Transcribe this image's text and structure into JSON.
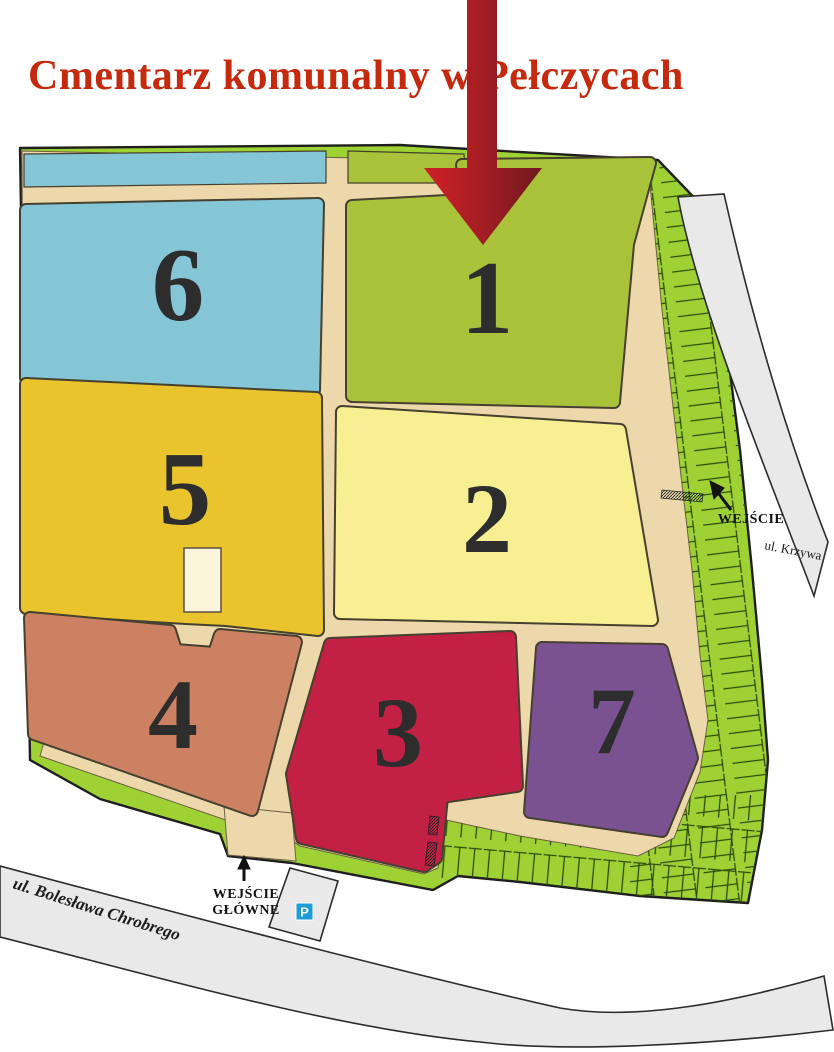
{
  "title": {
    "text": "Cmentarz komunalny w Pełczycach",
    "color": "#c5290e"
  },
  "sections": [
    {
      "label": "1",
      "color": "#a9c23a"
    },
    {
      "label": "2",
      "color": "#f7ef92"
    },
    {
      "label": "3",
      "color": "#c32045"
    },
    {
      "label": "4",
      "color": "#cb8162"
    },
    {
      "label": "5",
      "color": "#e9c42d"
    },
    {
      "label": "6",
      "color": "#84c6d6"
    },
    {
      "label": "7",
      "color": "#7b5291"
    }
  ],
  "entrances": {
    "main": {
      "line1": "WEJŚCIE",
      "line2": "GŁÓWNE"
    },
    "side": {
      "label": "WEJŚCIE"
    }
  },
  "streets": {
    "bottom": "ul. Bolesława Chrobrego",
    "right": "ul. Krzywa"
  },
  "parking": {
    "label": "P",
    "color": "#1e9cd8"
  },
  "map_colors": {
    "path_tan": "#ecd8ab",
    "green_belt": "#9ed234",
    "building": "#faf5da",
    "arrow_start": "#d02028",
    "arrow_mid": "#a31d23",
    "arrow_end": "#6e191e"
  }
}
